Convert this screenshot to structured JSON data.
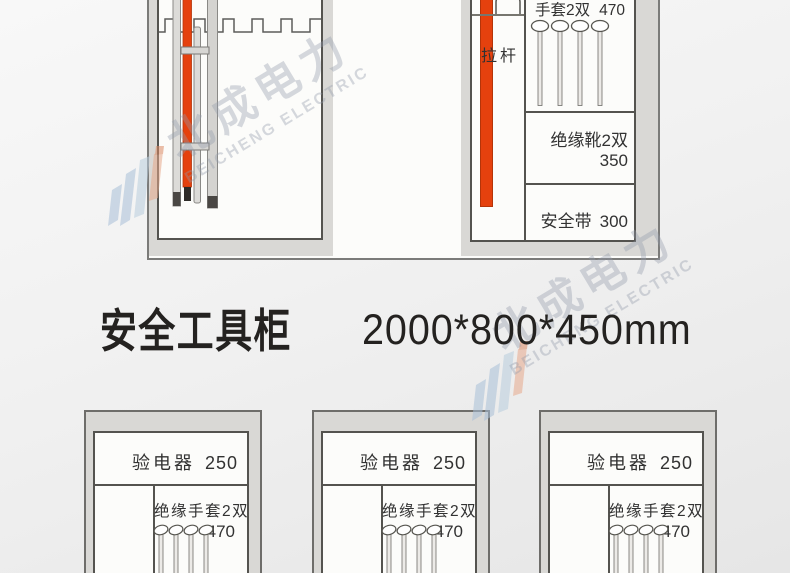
{
  "title": {
    "text": "安全工具柜",
    "dimensions": "2000*800*450mm"
  },
  "watermark": {
    "brand_cn": "北成电力",
    "brand_en": "BEICHENG ELECTRIC"
  },
  "top_cabinet": {
    "pull_rod_label": "拉杆",
    "shelf_sections": [
      {
        "label": "手套2双",
        "value": "470"
      },
      {
        "label": "绝缘靴2双",
        "value": "350"
      },
      {
        "label": "安全带",
        "value": "300"
      }
    ]
  },
  "bottom_cabinets": [
    {
      "tester_label": "验电器",
      "tester_value": "250",
      "gloves_label": "绝缘手套2双",
      "gloves_value": "470"
    },
    {
      "tester_label": "验电器",
      "tester_value": "250",
      "gloves_label": "绝缘手套2双",
      "gloves_value": "470"
    },
    {
      "tester_label": "验电器",
      "tester_value": "250",
      "gloves_label": "绝缘手套2双",
      "gloves_value": "470"
    }
  ],
  "colors": {
    "accent_red": "#e5410e",
    "rod_tip_black": "#2e2b28",
    "frame_gray": "#d9d8d5",
    "panel_white": "#fcfcfa",
    "line_dark": "#54534f",
    "watermark_gray_blue": "#949caa",
    "watermark_logo_blue": "#a9c0d8",
    "watermark_logo_orange": "#e7a98c"
  }
}
